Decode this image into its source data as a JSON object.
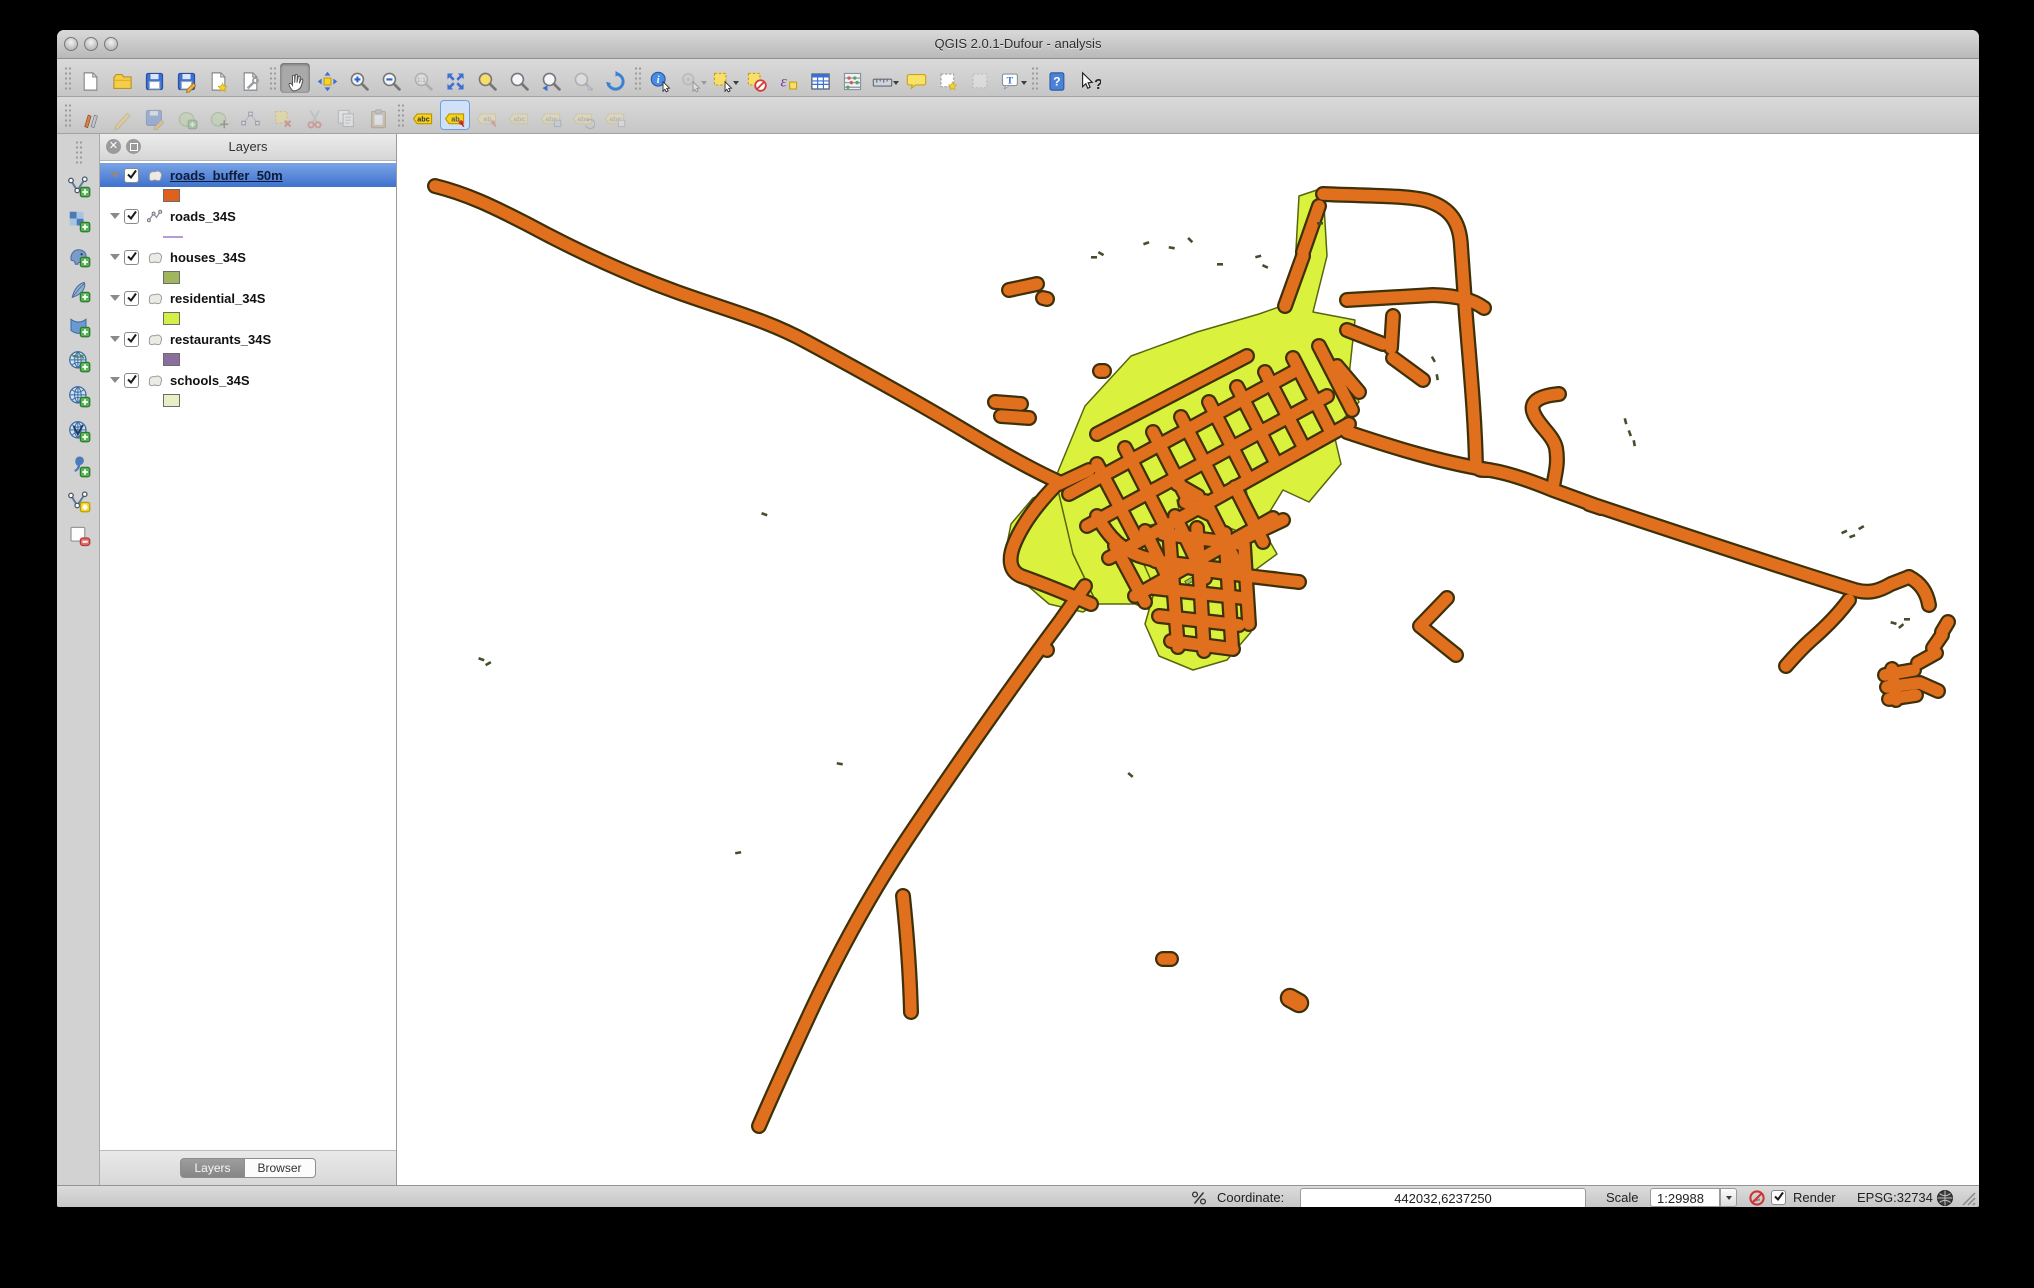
{
  "window": {
    "title": "QGIS 2.0.1-Dufour - analysis",
    "traffic_lights": [
      "close",
      "minimize",
      "zoom"
    ]
  },
  "colors": {
    "selection_blue": "#4a7fd6",
    "buffer_orange": "#e0701d",
    "road_outline": "#3e3009",
    "residential_green": "#daf23e",
    "residential_outline": "#57660e",
    "house_speck": "#41502a",
    "canvas_white": "#ffffff"
  },
  "toolbar_row1": [
    {
      "name": "new-project",
      "icon": "file-new-icon",
      "enabled": true
    },
    {
      "name": "open-project",
      "icon": "folder-open-icon",
      "enabled": true
    },
    {
      "name": "save-project",
      "icon": "save-icon",
      "enabled": true
    },
    {
      "name": "save-project-as",
      "icon": "save-as-icon",
      "enabled": true
    },
    {
      "name": "new-print-composer",
      "icon": "composer-new-icon",
      "enabled": true
    },
    {
      "name": "composer-manager",
      "icon": "composer-manager-icon",
      "enabled": true
    },
    {
      "sep": true
    },
    {
      "name": "pan-map",
      "icon": "hand-icon",
      "enabled": true,
      "active": true
    },
    {
      "name": "pan-to-selection",
      "icon": "pan-selection-icon",
      "enabled": true
    },
    {
      "name": "zoom-in",
      "icon": "zoom-in-icon",
      "enabled": true
    },
    {
      "name": "zoom-out",
      "icon": "zoom-out-icon",
      "enabled": true
    },
    {
      "name": "zoom-actual-size",
      "icon": "zoom-actual-icon",
      "enabled": false
    },
    {
      "name": "zoom-full-extent",
      "icon": "zoom-full-icon",
      "enabled": true
    },
    {
      "name": "zoom-to-selection",
      "icon": "zoom-selection-icon",
      "enabled": true
    },
    {
      "name": "zoom-to-layer",
      "icon": "zoom-layer-icon",
      "enabled": true
    },
    {
      "name": "zoom-last",
      "icon": "zoom-last-icon",
      "enabled": true
    },
    {
      "name": "zoom-next",
      "icon": "zoom-next-icon",
      "enabled": false
    },
    {
      "name": "refresh-map",
      "icon": "refresh-icon",
      "enabled": true
    },
    {
      "sep": true
    },
    {
      "name": "identify-features",
      "icon": "identify-icon",
      "enabled": true
    },
    {
      "name": "run-feature-action",
      "icon": "feature-action-icon",
      "enabled": false,
      "dropdown": true
    },
    {
      "name": "select-features",
      "icon": "select-icon",
      "enabled": true,
      "dropdown": true
    },
    {
      "name": "deselect-features",
      "icon": "deselect-icon",
      "enabled": true
    },
    {
      "name": "select-by-expression",
      "icon": "expression-icon",
      "enabled": true
    },
    {
      "name": "open-attribute-table",
      "icon": "attribute-table-icon",
      "enabled": true
    },
    {
      "name": "field-calculator",
      "icon": "calculator-icon",
      "enabled": true
    },
    {
      "name": "measure",
      "icon": "measure-icon",
      "enabled": true,
      "dropdown": true
    },
    {
      "name": "map-tips",
      "icon": "map-tips-icon",
      "enabled": true
    },
    {
      "name": "new-bookmark",
      "icon": "bookmark-new-icon",
      "enabled": true
    },
    {
      "name": "show-bookmarks",
      "icon": "bookmark-show-icon",
      "enabled": false
    },
    {
      "name": "text-annotation",
      "icon": "annotation-icon",
      "enabled": true,
      "dropdown": true
    },
    {
      "sep": true
    },
    {
      "name": "help",
      "icon": "help-icon",
      "enabled": true
    },
    {
      "name": "whats-this",
      "icon": "whats-this-icon",
      "enabled": true
    }
  ],
  "toolbar_row2": [
    {
      "name": "current-edits",
      "icon": "current-edits-icon",
      "enabled": true
    },
    {
      "name": "toggle-editing",
      "icon": "pencil-icon",
      "enabled": false
    },
    {
      "name": "save-layer-edits",
      "icon": "save-edits-icon",
      "enabled": false
    },
    {
      "name": "add-feature",
      "icon": "add-feature-icon",
      "enabled": false
    },
    {
      "name": "move-feature",
      "icon": "move-feature-icon",
      "enabled": false
    },
    {
      "name": "node-tool",
      "icon": "node-tool-icon",
      "enabled": false
    },
    {
      "name": "delete-selected",
      "icon": "delete-selected-icon",
      "enabled": false
    },
    {
      "name": "cut-features",
      "icon": "cut-icon",
      "enabled": false
    },
    {
      "name": "copy-features",
      "icon": "copy-icon",
      "enabled": false
    },
    {
      "name": "paste-features",
      "icon": "paste-icon",
      "enabled": false
    },
    {
      "sep": true
    },
    {
      "name": "layer-labeling",
      "icon": "label-abc-icon",
      "enabled": true
    },
    {
      "name": "highlight-pinned-labels",
      "icon": "label-pin-icon",
      "enabled": true,
      "bluesel": true
    },
    {
      "name": "pin-unpin-labels",
      "icon": "label-pin2-icon",
      "enabled": false
    },
    {
      "name": "show-hide-labels",
      "icon": "label-plain-icon",
      "enabled": false
    },
    {
      "name": "move-label",
      "icon": "label-move-icon",
      "enabled": false
    },
    {
      "name": "rotate-label",
      "icon": "label-rotate-icon",
      "enabled": false
    },
    {
      "name": "change-label",
      "icon": "label-props-icon",
      "enabled": false
    }
  ],
  "side_toolbar": [
    {
      "name": "add-vector-layer",
      "icon": "add-vector-icon",
      "enabled": true
    },
    {
      "name": "add-raster-layer",
      "icon": "add-raster-icon",
      "enabled": true
    },
    {
      "name": "add-postgis-layer",
      "icon": "add-postgis-icon",
      "enabled": true
    },
    {
      "name": "add-spatialite-layer",
      "icon": "add-spatialite-icon",
      "enabled": true
    },
    {
      "name": "add-mssql-layer",
      "icon": "add-mssql-icon",
      "enabled": true
    },
    {
      "name": "add-wms-layer",
      "icon": "add-wms-icon",
      "enabled": true
    },
    {
      "name": "add-wcs-layer",
      "icon": "add-wcs-icon",
      "enabled": true
    },
    {
      "name": "add-wfs-layer",
      "icon": "add-wfs-icon",
      "enabled": true
    },
    {
      "name": "add-delimited-text-layer",
      "icon": "add-csv-icon",
      "enabled": true
    },
    {
      "name": "new-shapefile-layer",
      "icon": "new-shapefile-icon",
      "enabled": true
    },
    {
      "name": "remove-layer",
      "icon": "remove-layer-icon",
      "enabled": true
    }
  ],
  "layers_panel": {
    "title": "Layers",
    "items": [
      {
        "name": "roads_buffer_50m",
        "checked": true,
        "selected": true,
        "type": "polygon",
        "swatch_kind": "fill",
        "swatch_color": "#e0611c"
      },
      {
        "name": "roads_34S",
        "checked": true,
        "selected": false,
        "type": "line",
        "swatch_kind": "line",
        "swatch_color": "#b49bd8"
      },
      {
        "name": "houses_34S",
        "checked": true,
        "selected": false,
        "type": "polygon",
        "swatch_kind": "fill",
        "swatch_color": "#9fb65c"
      },
      {
        "name": "residential_34S",
        "checked": true,
        "selected": false,
        "type": "polygon",
        "swatch_kind": "fill",
        "swatch_color": "#d6ef45"
      },
      {
        "name": "restaurants_34S",
        "checked": true,
        "selected": false,
        "type": "polygon",
        "swatch_kind": "fill",
        "swatch_color": "#8b6d9e"
      },
      {
        "name": "schools_34S",
        "checked": true,
        "selected": false,
        "type": "polygon",
        "swatch_kind": "fill",
        "swatch_color": "#e9efc5"
      }
    ],
    "tabs": [
      {
        "label": "Layers",
        "active": true
      },
      {
        "label": "Browser",
        "active": false
      }
    ]
  },
  "status_bar": {
    "coordinate_label": "Coordinate:",
    "coordinate_value": "442032,6237250",
    "scale_label": "Scale",
    "scale_value": "1:29988",
    "render_label": "Render",
    "render_checked": true,
    "crs_text": "EPSG:32734"
  }
}
